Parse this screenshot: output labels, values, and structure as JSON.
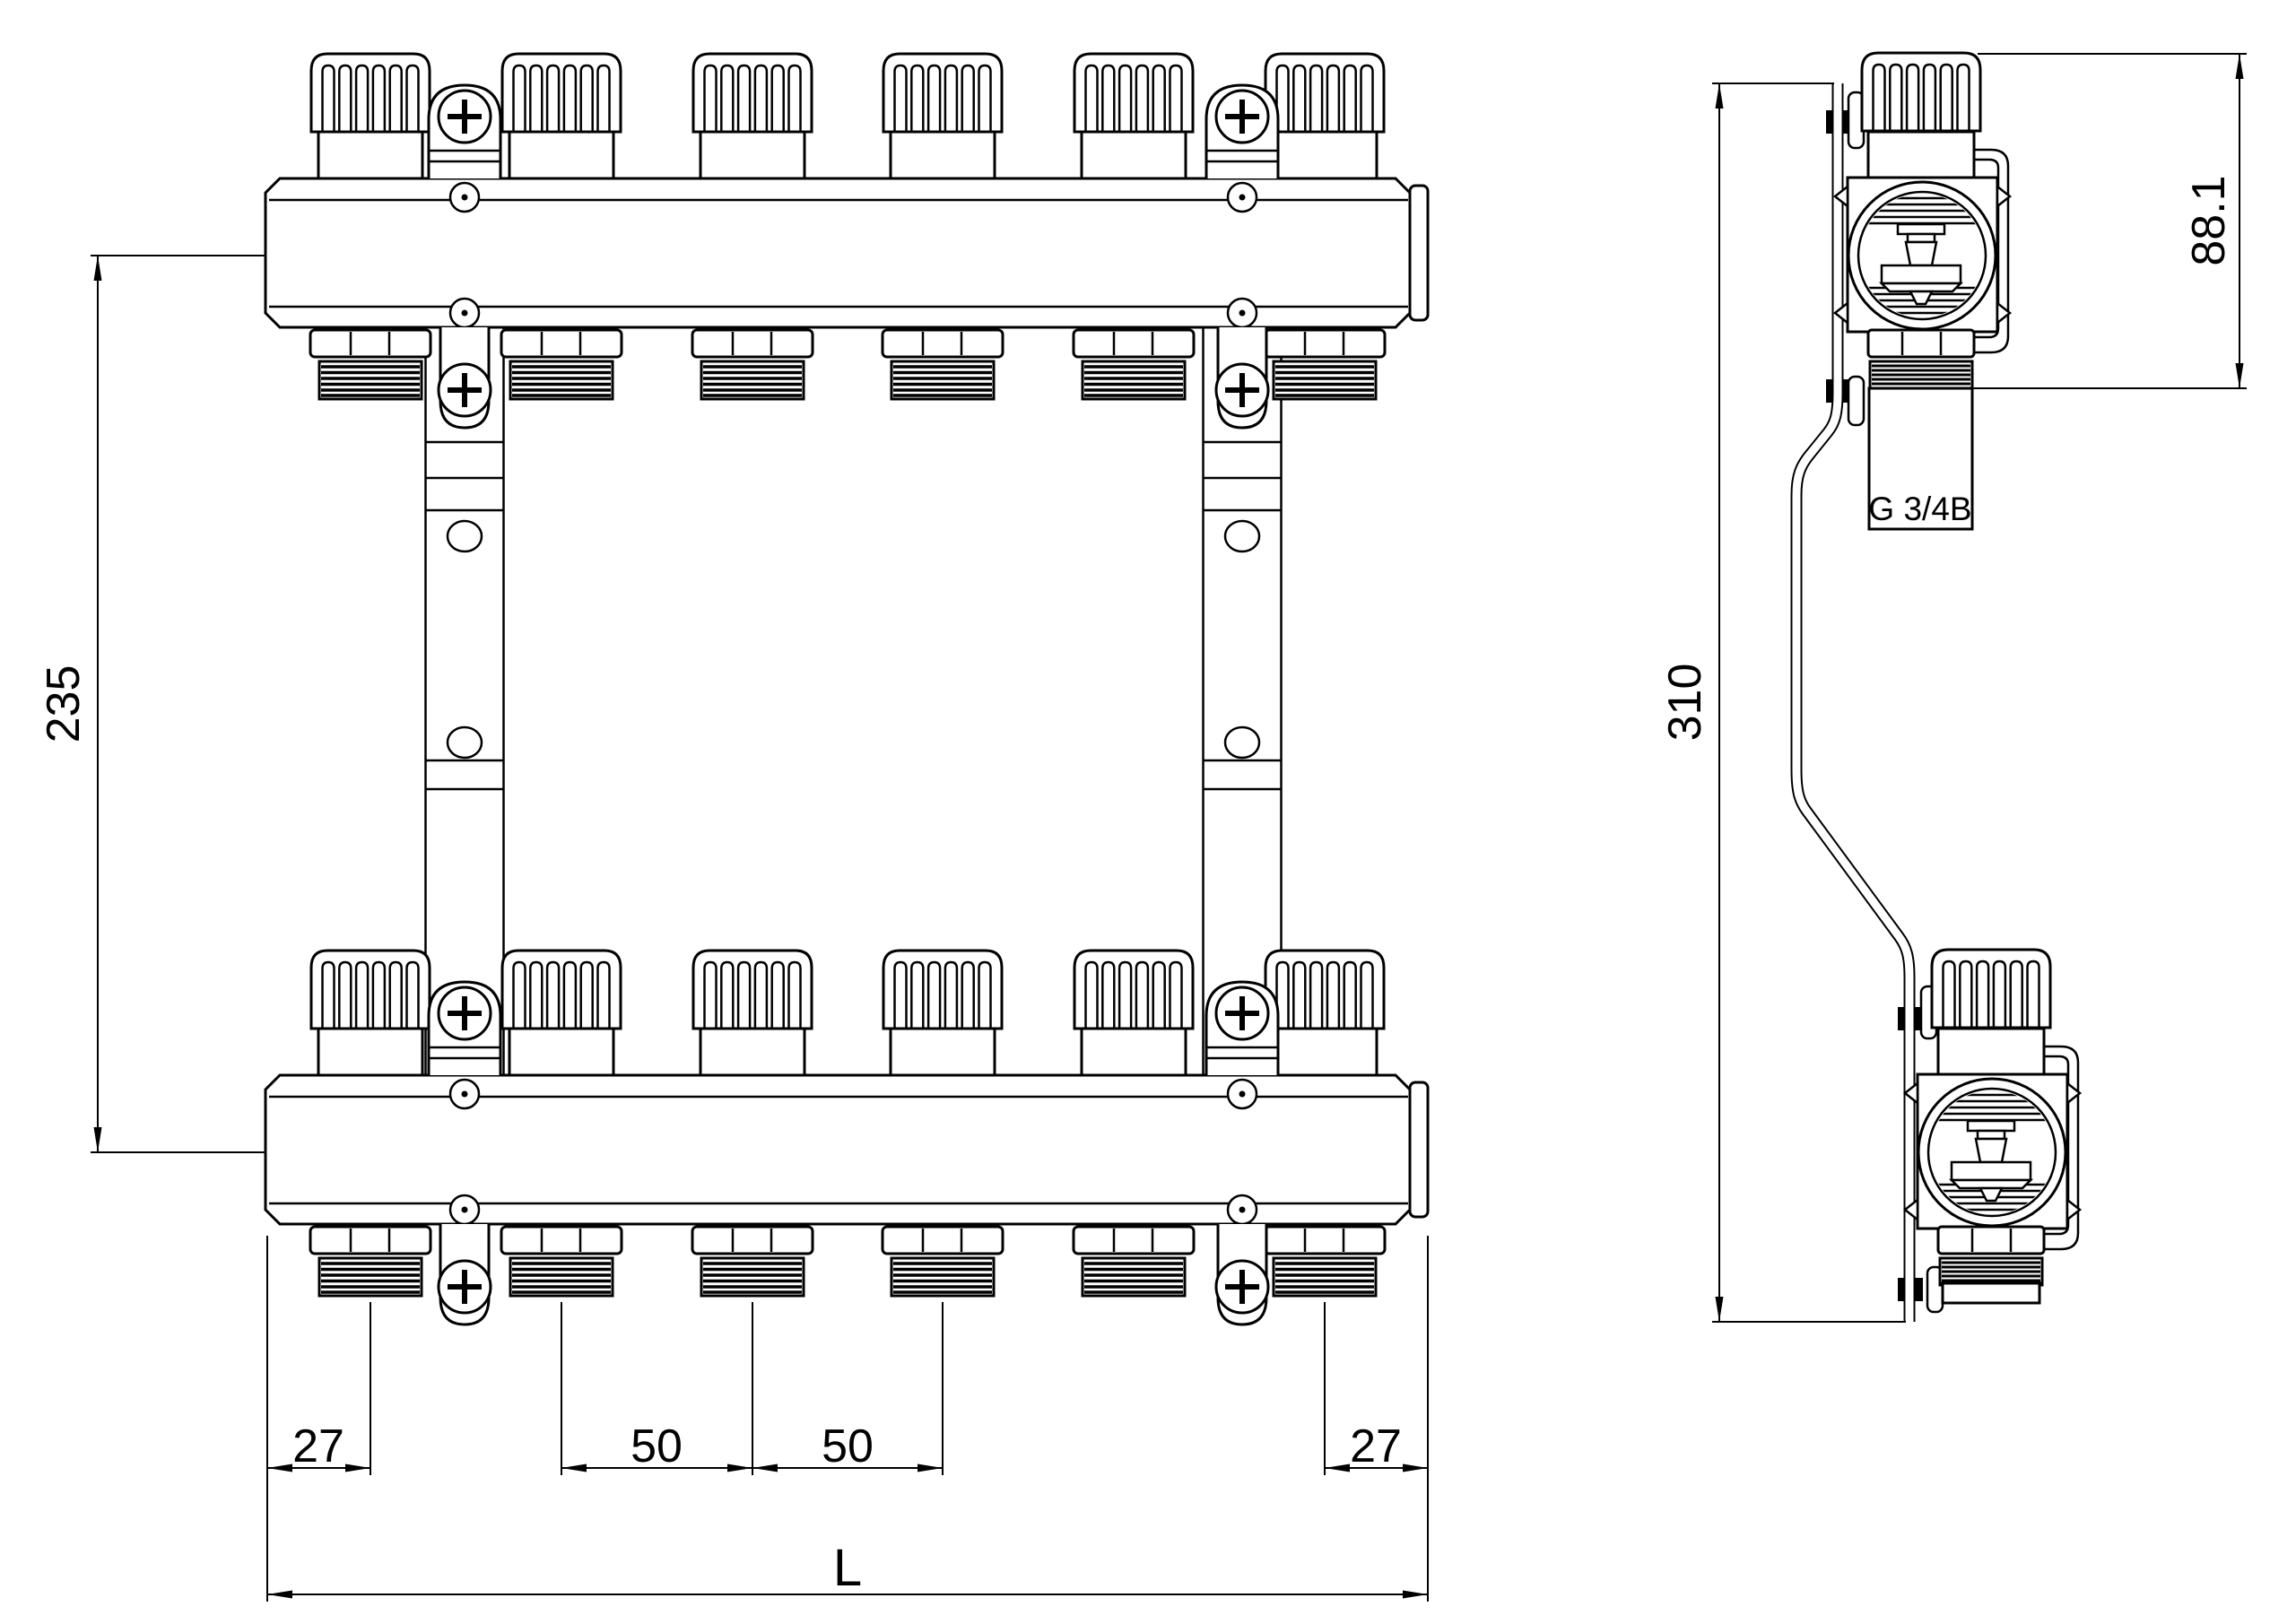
{
  "drawing": {
    "background": "#ffffff",
    "line_color": "#000000",
    "front_view": {
      "title": "manifold front view",
      "port_count_per_bar": 6,
      "dim_bar_spacing": "235",
      "dim_edge_to_first_port": "27",
      "dim_port_pitch_1": "50",
      "dim_port_pitch_2": "50",
      "dim_last_port_to_edge": "27",
      "dim_overall_length": "L"
    },
    "side_view": {
      "title": "manifold side view",
      "dim_overall_height": "310",
      "dim_valve_unit_height": "88.1",
      "thread_spec": "G 3/4B"
    }
  }
}
